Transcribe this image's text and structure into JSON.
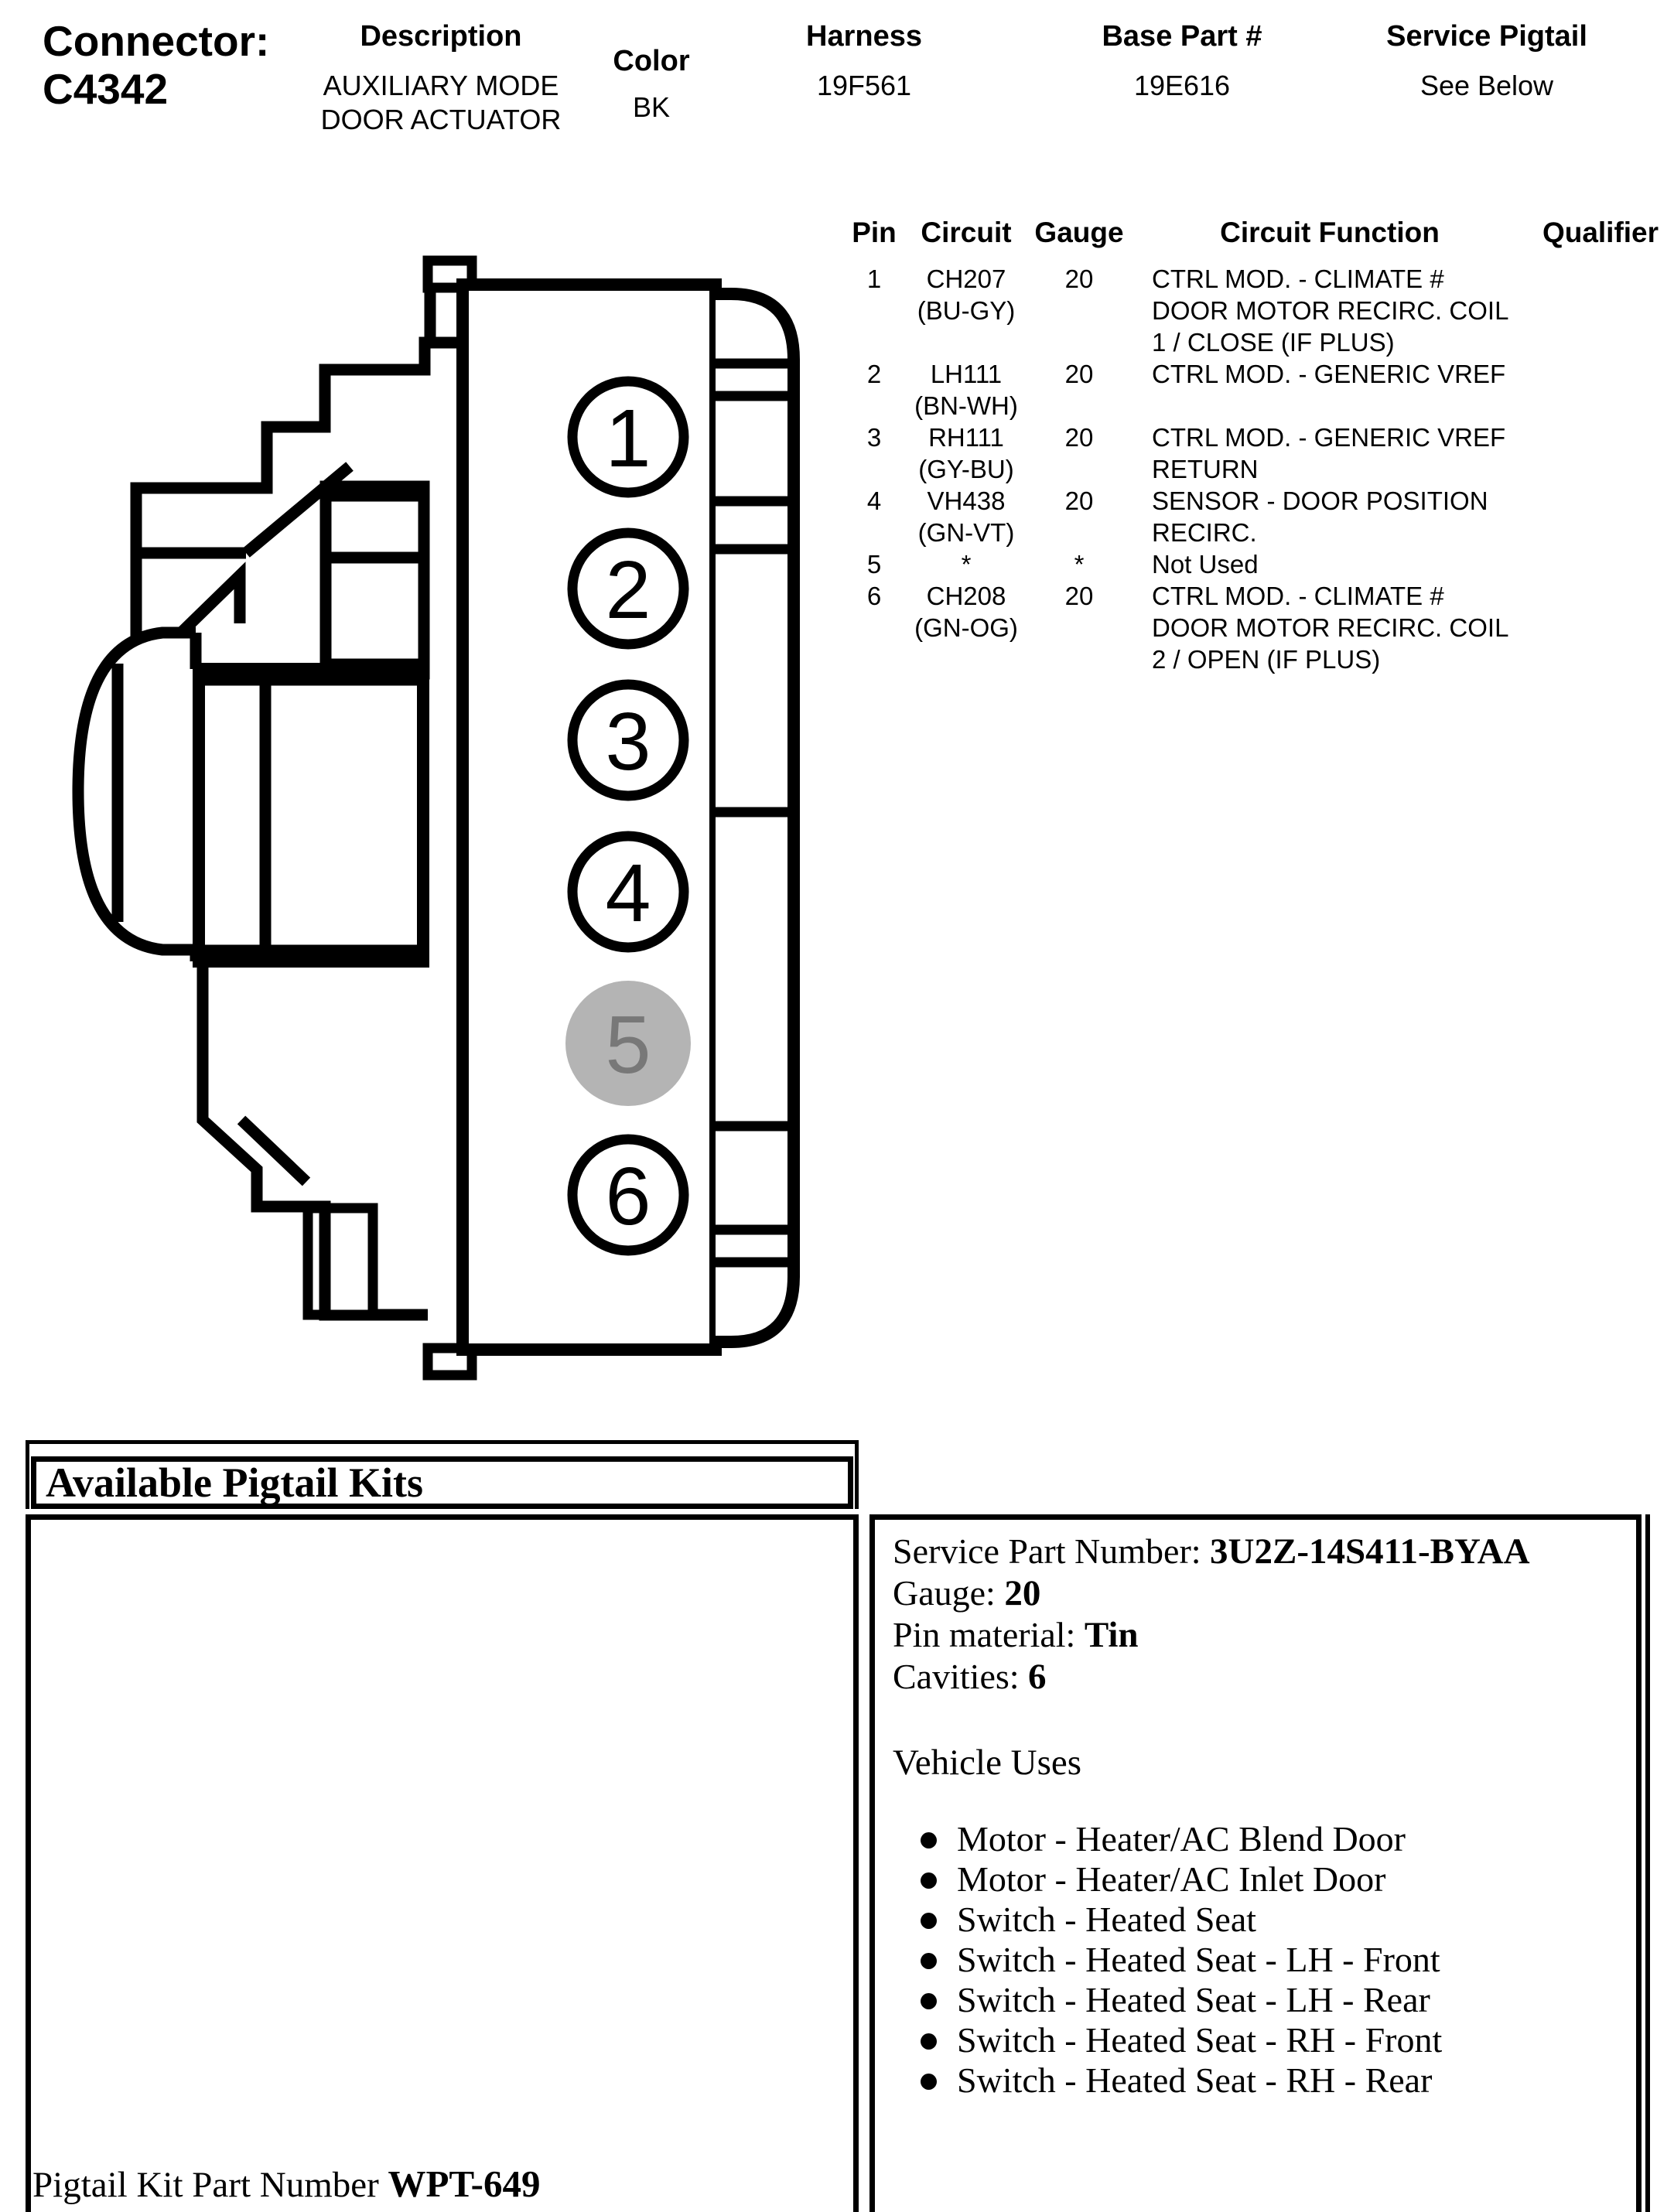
{
  "header": {
    "connector_label": "Connector:",
    "connector_id": "C4342",
    "columns": [
      {
        "label": "Description",
        "value": "AUXILIARY MODE\nDOOR ACTUATOR"
      },
      {
        "label": "Color",
        "value": "BK"
      },
      {
        "label": "Harness",
        "value": "19F561"
      },
      {
        "label": "Base Part #",
        "value": "19E616"
      },
      {
        "label": "Service Pigtail",
        "value": "See Below"
      }
    ]
  },
  "pin_table": {
    "headers": [
      "Pin",
      "Circuit",
      "Gauge",
      "Circuit Function",
      "Qualifier"
    ],
    "rows": [
      {
        "pin": "1",
        "circuit": "CH207",
        "circuit_color": "(BU-GY)",
        "gauge": "20",
        "function_lines": [
          "CTRL MOD. - CLIMATE #",
          "DOOR MOTOR RECIRC. COIL",
          "1 / CLOSE (IF PLUS)"
        ],
        "qualifier": ""
      },
      {
        "pin": "2",
        "circuit": "LH111",
        "circuit_color": "(BN-WH)",
        "gauge": "20",
        "function_lines": [
          "CTRL MOD. - GENERIC VREF"
        ],
        "qualifier": ""
      },
      {
        "pin": "3",
        "circuit": "RH111",
        "circuit_color": "(GY-BU)",
        "gauge": "20",
        "function_lines": [
          "CTRL MOD. - GENERIC VREF",
          "RETURN"
        ],
        "qualifier": ""
      },
      {
        "pin": "4",
        "circuit": "VH438",
        "circuit_color": "(GN-VT)",
        "gauge": "20",
        "function_lines": [
          "SENSOR - DOOR POSITION",
          "RECIRC."
        ],
        "qualifier": ""
      },
      {
        "pin": "5",
        "circuit": "*",
        "circuit_color": "",
        "gauge": "*",
        "function_lines": [
          "Not Used"
        ],
        "qualifier": ""
      },
      {
        "pin": "6",
        "circuit": "CH208",
        "circuit_color": "(GN-OG)",
        "gauge": "20",
        "function_lines": [
          "CTRL MOD. - CLIMATE #",
          "DOOR MOTOR RECIRC. COIL",
          "2 / OPEN (IF PLUS)"
        ],
        "qualifier": ""
      }
    ]
  },
  "connector_diagram": {
    "pins": [
      {
        "number": "1",
        "used": true
      },
      {
        "number": "2",
        "used": true
      },
      {
        "number": "3",
        "used": true
      },
      {
        "number": "4",
        "used": true
      },
      {
        "number": "5",
        "used": false
      },
      {
        "number": "6",
        "used": true
      }
    ],
    "unused_fill": "#b4b4b4",
    "unused_text_color": "#787878",
    "line_color": "#000000"
  },
  "pigtail_section": {
    "title": "Available Pigtail Kits",
    "details": [
      {
        "label": "Service Part Number: ",
        "value": "3U2Z-14S411-BYAA"
      },
      {
        "label": "Gauge: ",
        "value": "20"
      },
      {
        "label": "Pin material: ",
        "value": "Tin"
      },
      {
        "label": "Cavities: ",
        "value": "6"
      }
    ],
    "vehicle_uses_title": "Vehicle Uses",
    "vehicle_uses": [
      "Motor - Heater/AC Blend Door",
      "Motor - Heater/AC Inlet Door",
      "Switch - Heated Seat",
      "Switch - Heated Seat - LH - Front",
      "Switch - Heated Seat - LH - Rear",
      "Switch - Heated Seat - RH - Front",
      "Switch - Heated Seat - RH - Rear"
    ],
    "kit_part_label": "Pigtail Kit Part Number ",
    "kit_part_number": "WPT-649"
  }
}
